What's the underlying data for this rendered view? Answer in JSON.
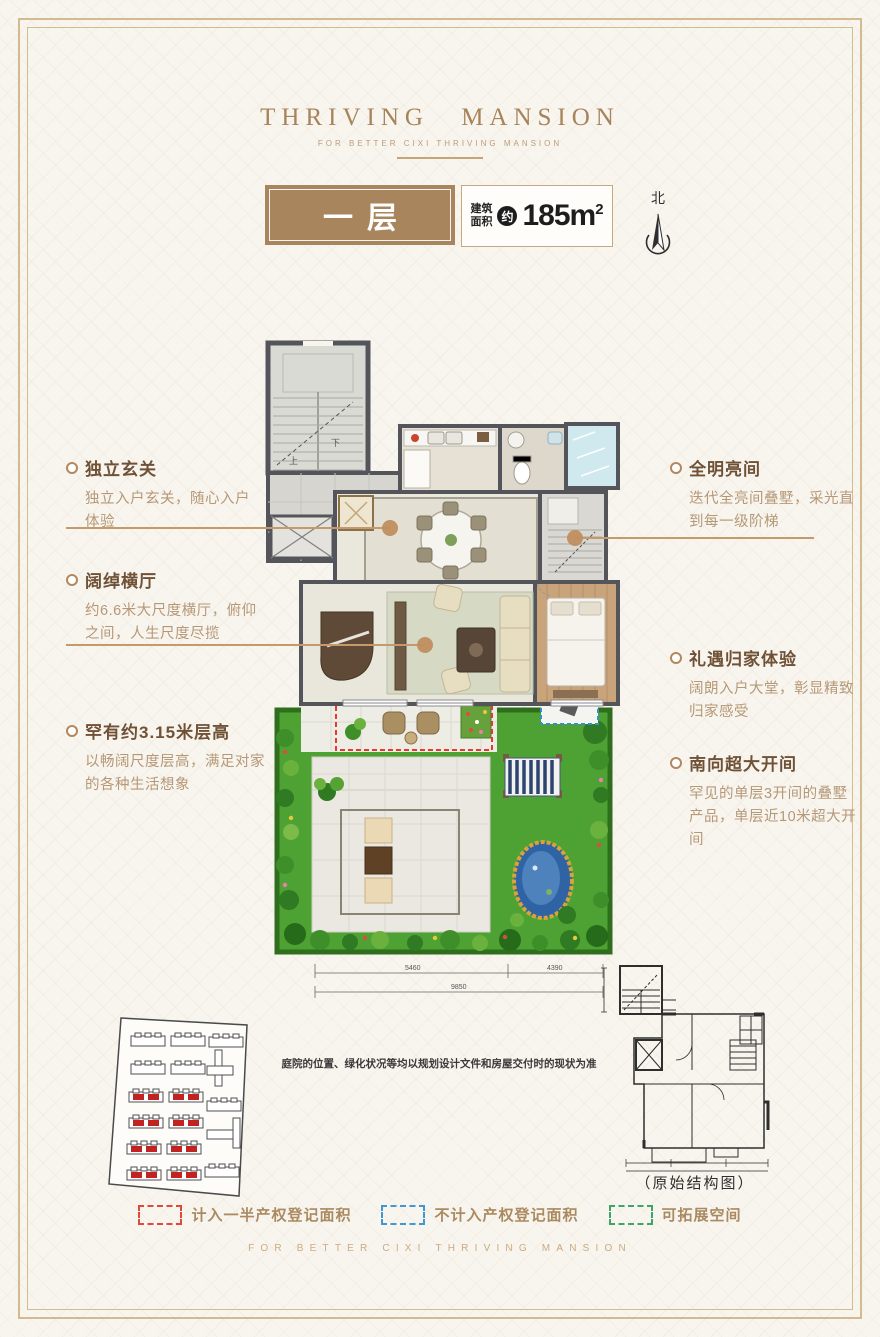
{
  "brand": {
    "logo": "THRIVING MANSION",
    "tagline": "FOR BETTER CIXI THRIVING MANSION"
  },
  "header": {
    "floor_label": "一层",
    "area_label_line1": "建筑",
    "area_label_line2": "面积",
    "approx_badge": "约",
    "area_value": "185m",
    "area_exponent": "2",
    "north_label": "北"
  },
  "features_left": [
    {
      "title": "独立玄关",
      "desc": "独立入户玄关，随心入户体验"
    },
    {
      "title": "阔绰横厅",
      "desc": "约6.6米大尺度横厅，俯仰之间，人生尺度尽揽"
    },
    {
      "title": "罕有约3.15米层高",
      "desc": "以畅阔尺度层高，满足对家的各种生活想象"
    }
  ],
  "features_right": [
    {
      "title": "全明亮间",
      "desc": "迭代全亮间叠墅，采光直到每一级阶梯"
    },
    {
      "title": "礼遇归家体验",
      "desc": "阔朗入户大堂，彰显精致归家感受"
    },
    {
      "title": "南向超大开间",
      "desc": "罕见的单层3开间的叠墅产品，单层近10米超大开间"
    }
  ],
  "plan": {
    "stair_up_label": "上",
    "stair_down_label": "下",
    "dimensions": {
      "left_mm": "5460",
      "right_mm": "4390",
      "total_mm": "9850"
    }
  },
  "notes": {
    "disclaimer": "庭院的位置、绿化状况等均以规划设计文件和房屋交付时的现状为准",
    "structure_caption": "（原始结构图）"
  },
  "legend": {
    "items": [
      {
        "label": "计入一半产权登记面积",
        "color": "#e2473b"
      },
      {
        "label": "不计入产权登记面积",
        "color": "#3f97d4"
      },
      {
        "label": "可拓展空间",
        "color": "#3fa469"
      }
    ]
  },
  "footer": {
    "tagline": "FOR BETTER CIXI THRIVING MANSION"
  },
  "theme": {
    "accent_brown": "#a8855c",
    "title_brown": "#6f5136",
    "body_brown": "#b59876",
    "frame_gold": "#d4ba90",
    "leader_tan": "#c49a6c"
  }
}
